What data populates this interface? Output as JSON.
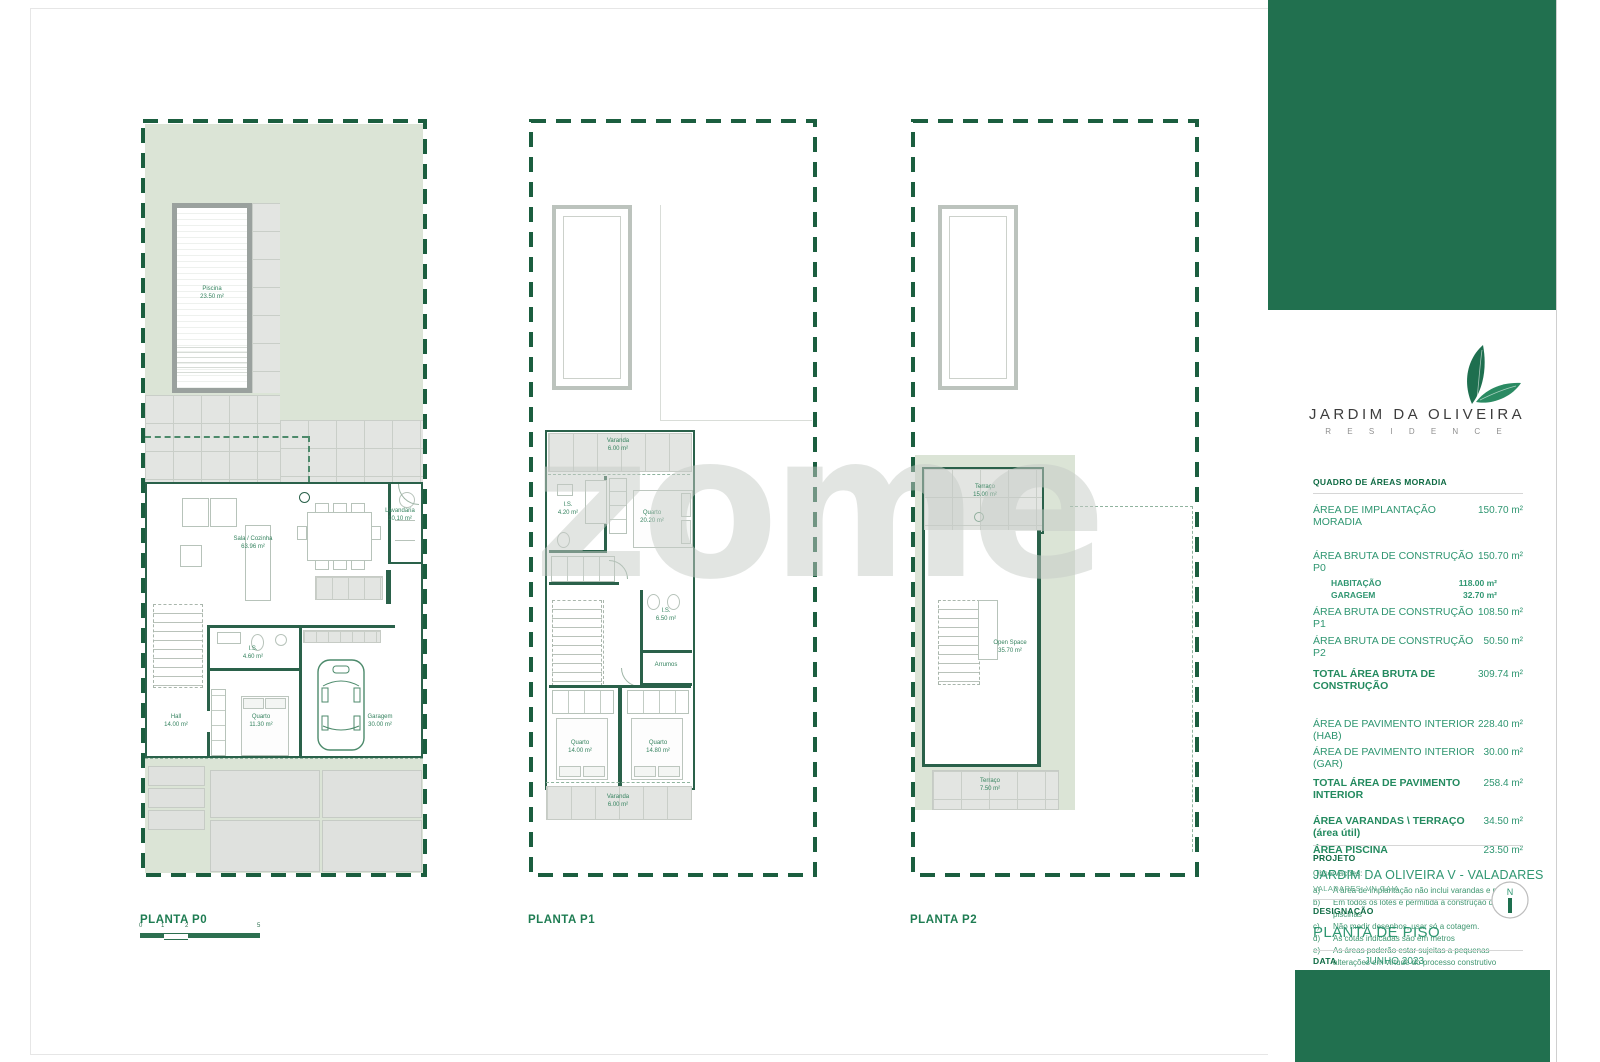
{
  "watermark": "zome",
  "colors": {
    "brand_green": "#21704f",
    "text_green": "#2f9671",
    "wall_green": "#2a614a",
    "garden_sage": "#dbe4d6"
  },
  "plans": {
    "p0": {
      "caption": "PLANTA P0",
      "rooms": {
        "piscina": {
          "name": "Piscina",
          "area": "23.50 m²"
        },
        "sala": {
          "name": "Sala / Cozinha",
          "area": "63.96 m²"
        },
        "lavandaria": {
          "name": "Lavandaria",
          "area": "10.10 m²"
        },
        "is": {
          "name": "I.S.",
          "area": "4.60 m²"
        },
        "hall": {
          "name": "Hall",
          "area": "14.00 m²"
        },
        "quarto": {
          "name": "Quarto",
          "area": "11.30 m²"
        },
        "garagem": {
          "name": "Garagem",
          "area": "30.00 m²"
        }
      },
      "scale_labels": [
        "0",
        "1",
        "2",
        "5"
      ]
    },
    "p1": {
      "caption": "PLANTA P1",
      "rooms": {
        "varanda_top": {
          "name": "Varanda",
          "area": "6.00 m²"
        },
        "is1": {
          "name": "I.S.",
          "area": "4.20 m²"
        },
        "quarto1": {
          "name": "Quarto",
          "area": "20.20 m²"
        },
        "is2": {
          "name": "I.S.",
          "area": "6.50 m²"
        },
        "arrumos": {
          "name": "Arrumos",
          "area": ""
        },
        "quarto2": {
          "name": "Quarto",
          "area": "14.00 m²"
        },
        "quarto3": {
          "name": "Quarto",
          "area": "14.80 m²"
        },
        "varanda_bottom": {
          "name": "Varanda",
          "area": "6.00 m²"
        }
      }
    },
    "p2": {
      "caption": "PLANTA P2",
      "rooms": {
        "terraco_top": {
          "name": "Terraço",
          "area": "15.00 m²"
        },
        "open_space": {
          "name": "Open Space",
          "area": "35.70 m²"
        },
        "terraco_bottom": {
          "name": "Terraço",
          "area": "7.50 m²"
        }
      }
    }
  },
  "sidebar": {
    "brand": {
      "title": "JARDIM DA OLIVEIRA",
      "subtitle": "R E S I D E N C E"
    },
    "table": {
      "heading": "QUADRO DE ÁREAS MORADIA",
      "rows": [
        {
          "label": "ÁREA DE IMPLANTAÇÃO MORADIA",
          "value": "150.70 m²"
        },
        {
          "label": "ÁREA BRUTA DE CONSTRUÇÃO P0",
          "value": "150.70 m²"
        },
        {
          "label": "HABITAÇÃO",
          "value": "118.00 m²"
        },
        {
          "label": "GARAGEM",
          "value": "32.70 m²"
        },
        {
          "label": "ÁREA BRUTA DE CONSTRUÇÃO P1",
          "value": "108.50 m²"
        },
        {
          "label": "ÁREA BRUTA DE CONSTRUÇÃO P2",
          "value": "50.50 m²"
        },
        {
          "label": "TOTAL ÁREA BRUTA DE CONSTRUÇÃO",
          "value": "309.74 m²"
        },
        {
          "label": "ÁREA DE PAVIMENTO INTERIOR (HAB)",
          "value": "228.40 m²"
        },
        {
          "label": "ÁREA DE PAVIMENTO INTERIOR (GAR)",
          "value": "30.00 m²"
        },
        {
          "label": "TOTAL ÁREA DE PAVIMENTO INTERIOR",
          "value": "258.4 m²"
        },
        {
          "label": "ÁREA VARANDAS \\ TERRAÇO (área útil)",
          "value": "34.50 m²"
        },
        {
          "label": "ÁREA PISCINA",
          "value": "23.50 m²"
        }
      ]
    },
    "observations": {
      "heading": "Observações:",
      "items": [
        {
          "key": "a)",
          "text": "A área de implantação não inclui varandas e palas"
        },
        {
          "key": "b)",
          "text": "Em todos os lotes é permitida a construção de piscinas"
        },
        {
          "key": "c)",
          "text": "Não medir desenhos, usar só a cotagem."
        },
        {
          "key": "d)",
          "text": "As cotas indicadas são em metros"
        },
        {
          "key": "e)",
          "text": "As áreas poderão estar sujeitas a pequenas alterações em virtude do processo construtivo"
        }
      ]
    },
    "project": {
      "label": "PROJETO",
      "title": "JARDIM DA OLIVEIRA V - VALADARES",
      "subtitle": "VALADARES, VN GAIA"
    },
    "designation": {
      "label": "DESIGNAÇÃO",
      "title": "PLANTA DE PISO",
      "north": "N"
    },
    "date": {
      "label": "DATA",
      "value": "JUNHO 2023"
    },
    "disclaimer": "Este desenho é propriedade dos autores e não pode ser reproduzido, divulgado ou copiado, no todo ou em parte, sem autorização expressa. Em caso de incoerências e disparidade entre desenhos de escalas diferentes, será sempre a maior a vigorar, isto é, os técnicos e executantes devem sempre reger-se pelas escalas maiores. Todas as medidas serão confirmadas em obra."
  }
}
